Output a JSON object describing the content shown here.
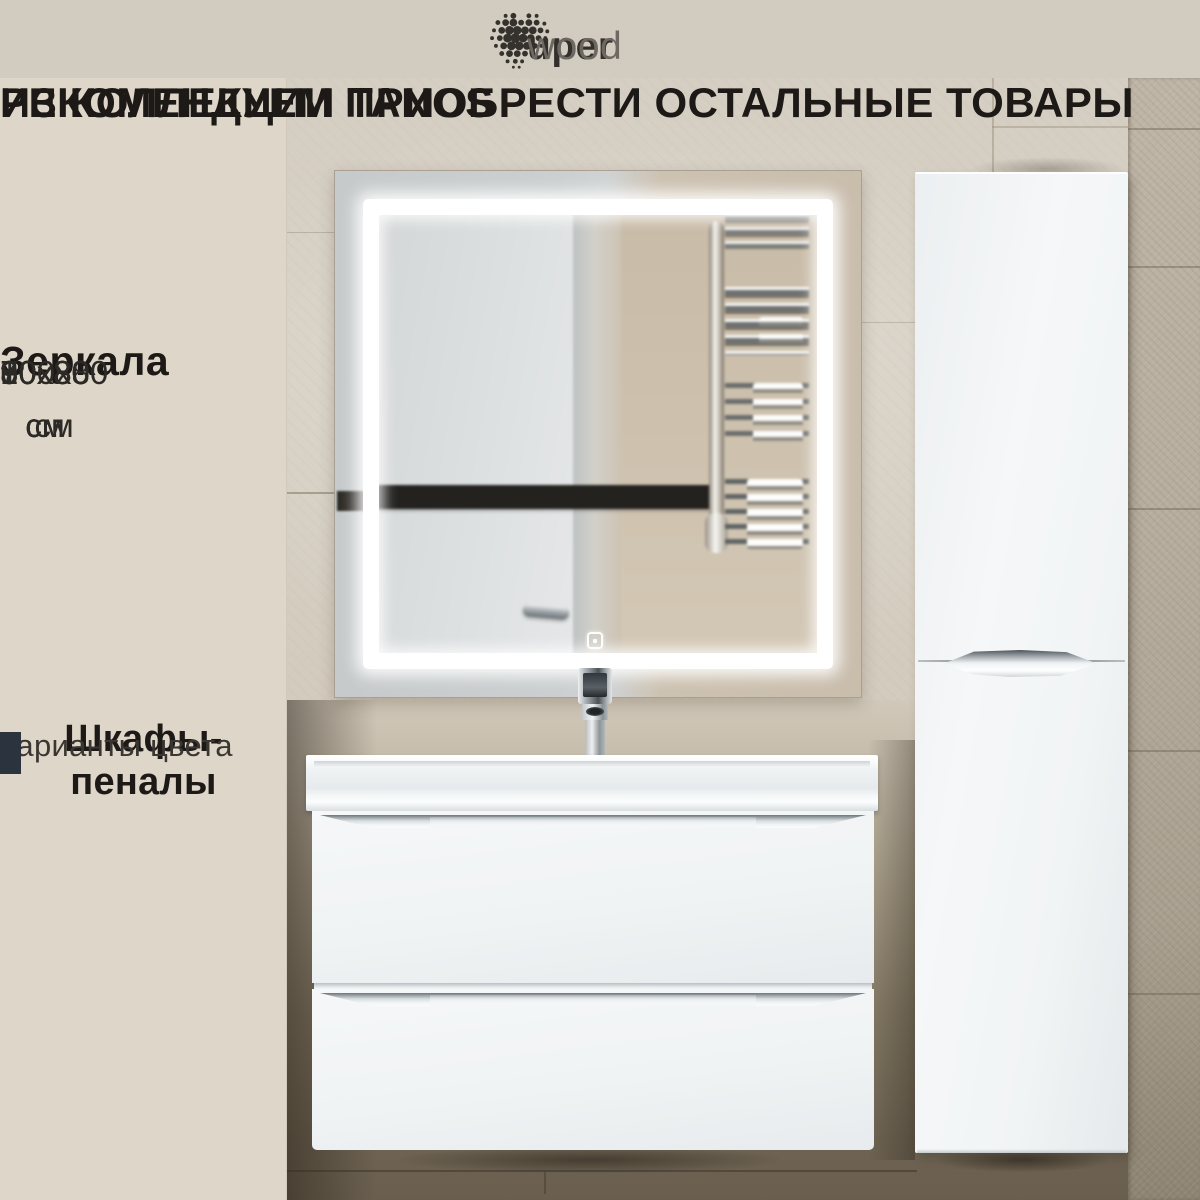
{
  "brand": {
    "name": "uperwood",
    "logo_bold": "uper",
    "logo_light": "wood"
  },
  "heading": {
    "line1": "РЕКОМЕНДУЕМ ПРИОБРЕСТИ ОСТАЛЬНЫЕ ТОВАРЫ",
    "line2": "ИЗ КОЛЛЕКЦИИ TANOS"
  },
  "mirrors": {
    "title": "Зеркала",
    "sizes": [
      "60х80 см",
      "70х80 см",
      "80х80 см",
      "90х80 см",
      "100х80 см"
    ]
  },
  "pencil_cabinets": {
    "title": "Шкафы-пеналы",
    "subtitle": "варианты цвета",
    "swatches": [
      {
        "name": "white",
        "color": "#ffffff"
      },
      {
        "name": "white-and-dark",
        "color_top_right": "#2b333e",
        "color_bottom_left": "#ffffff"
      },
      {
        "name": "dark-graphite",
        "color": "#2b333e"
      }
    ]
  },
  "theme": {
    "text_dark": "#1c1916",
    "band_bg": "#d2cbc0",
    "panel_bg": "#ded6c9",
    "wall_light": "#d6cfc3",
    "lower_wall": "#7b7162",
    "tile_column": "#b5ac9d",
    "furniture_white": "#f2f4f6",
    "stripe_dark": "#23221f",
    "swatch_white": "#ffffff",
    "swatch_dark": "#2b333e",
    "led": "#ffffff",
    "chrome": "#aab0b4"
  }
}
